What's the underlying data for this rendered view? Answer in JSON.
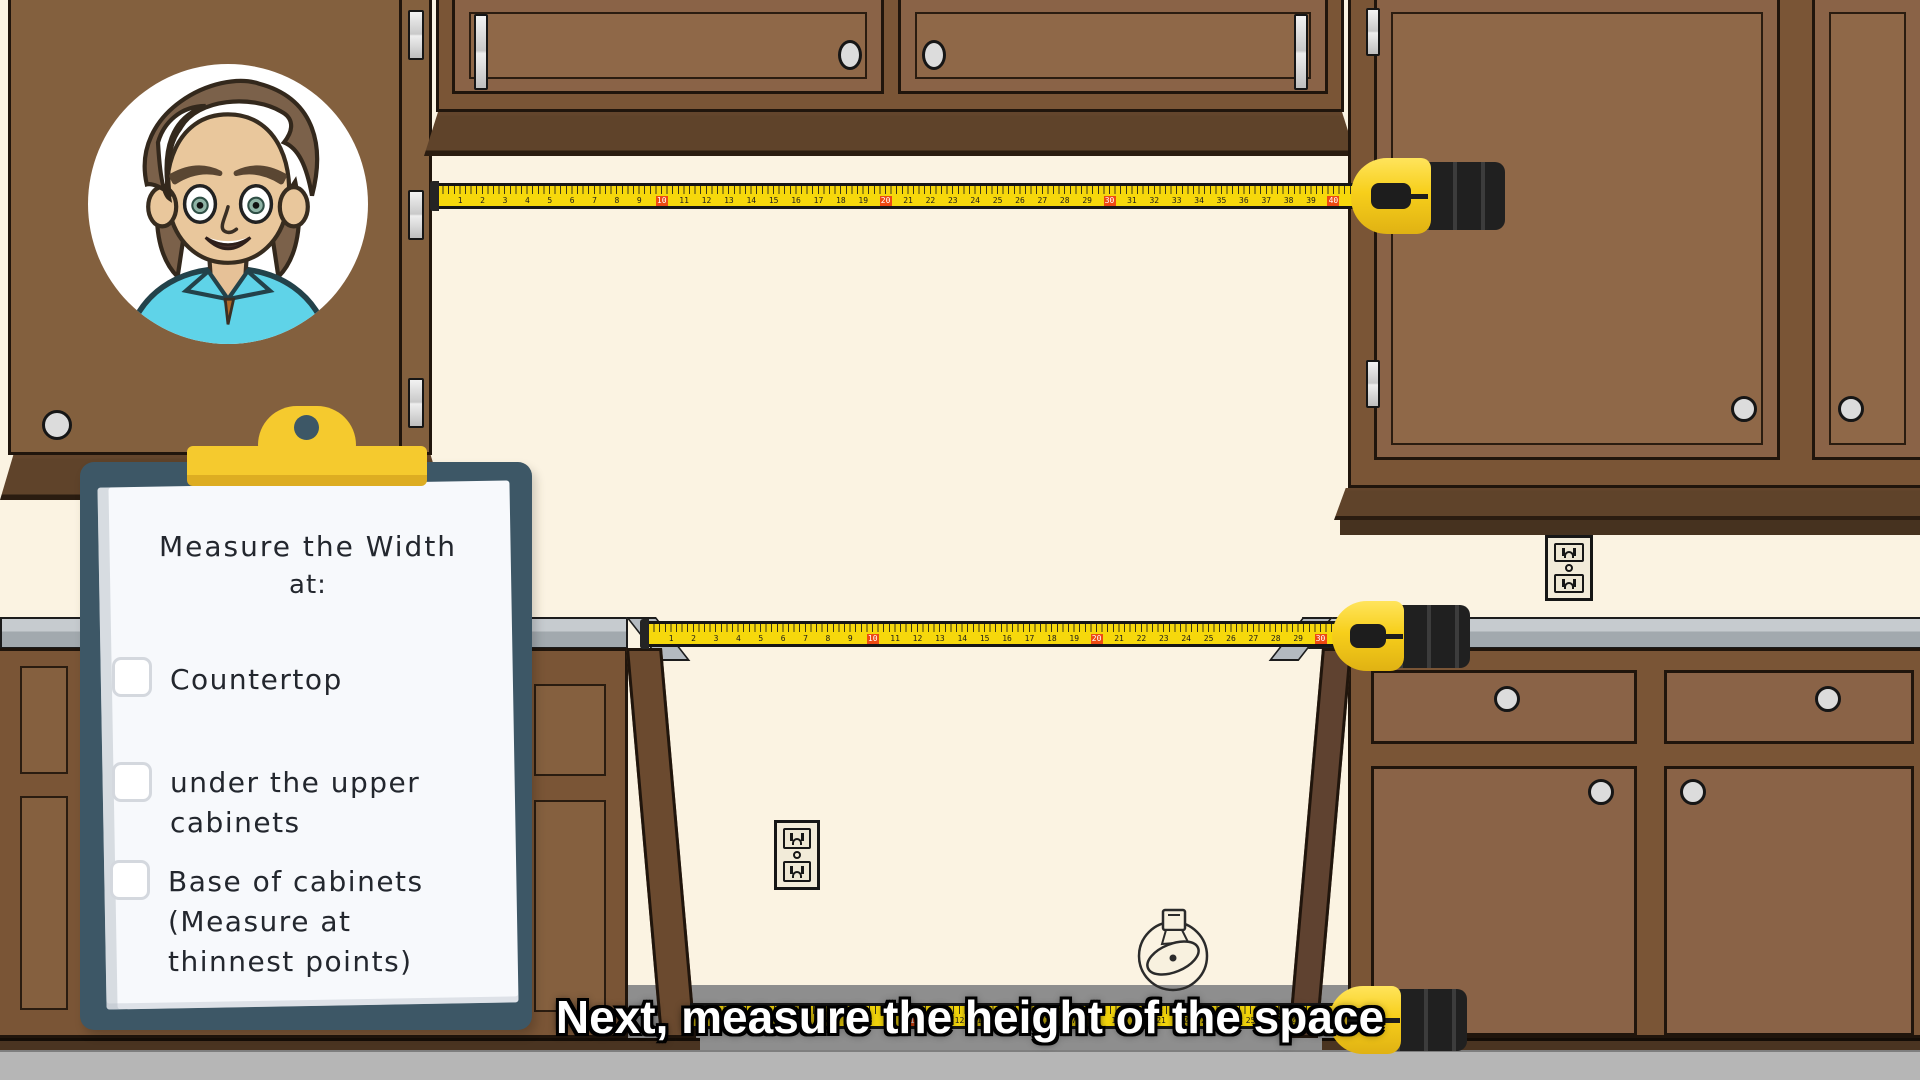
{
  "caption": {
    "text": "Next, measure the height of the space"
  },
  "clipboard": {
    "title": "Measure the Width",
    "title_suffix": "at:",
    "items": [
      {
        "label": "Countertop",
        "checked": false
      },
      {
        "label": "under the upper cabinets",
        "checked": false
      },
      {
        "label": "Base of cabinets (Measure at thinnest points)",
        "checked": false
      }
    ]
  },
  "avatar": {
    "description": "cartoon man with brown wavy hair and teal collared shirt"
  },
  "measuring_tapes": [
    {
      "name": "upper-cabinet-width-tape",
      "numbers_from": 1,
      "numbers_to": 40,
      "marker_every": 10
    },
    {
      "name": "countertop-width-tape",
      "numbers_from": 1,
      "numbers_to": 30,
      "marker_every": 10
    },
    {
      "name": "cabinet-base-width-tape",
      "numbers_from": 1,
      "numbers_to": 28,
      "marker_every": 10
    }
  ],
  "icons": {
    "wall_drawing": "tape-measure-outline",
    "outlets": "duplex-electrical-outlet"
  },
  "colors": {
    "wall": "#fbf3e2",
    "cabinet_frame": "#7a5536",
    "cabinet_door": "#8a6347",
    "countertop": "#b7bdc2",
    "tape_yellow": "#f6d80c",
    "tape_marker_orange": "#ee4a12",
    "tape_case_yellow": "#f7cf1b",
    "clipboard_board": "#3d5766",
    "clip_yellow": "#f5ca2e",
    "floor_gray": "#b6b6b6",
    "caption_text": "#ffffff"
  }
}
